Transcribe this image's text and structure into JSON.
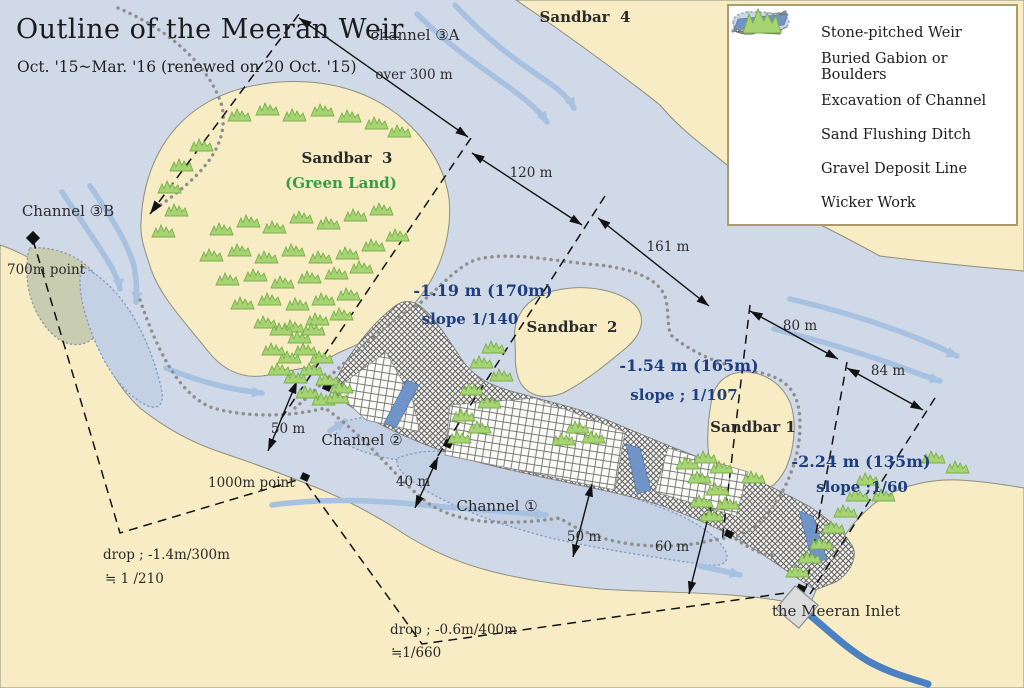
{
  "title": {
    "main": "Outline of the Meeran Weir",
    "subtitle": "Oct. '15~Mar. '16 (renewed on 20 Oct. '15)"
  },
  "legend": {
    "items": [
      {
        "icon": "stone-pitched-weir-swatch",
        "label": "Stone-pitched Weir"
      },
      {
        "icon": "buried-gabion-swatch",
        "label": "Buried Gabion or Boulders"
      },
      {
        "icon": "excavation-swatch",
        "label": "Excavation of Channel"
      },
      {
        "icon": "sand-flushing-ditch-swatch",
        "label": "Sand Flushing Ditch"
      },
      {
        "icon": "gravel-deposit-line-swatch",
        "label": "Gravel Deposit Line"
      },
      {
        "icon": "wicker-work-swatch",
        "label": "Wicker Work"
      }
    ]
  },
  "labels": {
    "sandbar4": "Sandbar  4",
    "sandbar3": "Sandbar  3",
    "green_land": "(Green Land)",
    "sandbar2": "Sandbar  2",
    "sandbar1": "Sandbar 1",
    "channel_3a": "channel ③A",
    "channel_3b": "Channel ③B",
    "channel_2": "Channel ②",
    "channel_1": "Channel ①",
    "inlet": "the Meeran Inlet",
    "point_700": "700m point",
    "point_1000": "1000m point"
  },
  "measurements": {
    "over_300": "over 300 m",
    "m120": "120 m",
    "m161": "161 m",
    "m80": "80 m",
    "m84": "84 m",
    "m50_upper": "50 m",
    "m40": "40 m",
    "m50_lower": "50 m",
    "m60": "60 m",
    "depth_1": "-1.19 m (170m)",
    "slope_1": "slope 1/140",
    "depth_2": "-1.54 m (165m)",
    "slope_2": "slope ; 1/107",
    "depth_3": "-2.24 m (135m)",
    "slope_3": "slope ;1/60",
    "drop_1": "drop ; -1.4m/300m",
    "drop_1_ratio": "≒ 1 /210",
    "drop_2": "drop ; -0.6m/400m",
    "drop_2_ratio": "≒1/660"
  },
  "colors": {
    "water": "#cfd9e7",
    "sand": "#f7ecc4",
    "excavation": "#c4d1e4",
    "ditch_blue": "#7094c8",
    "flow_arrow": "#a7c1e0",
    "wicker_green": "#a6d473",
    "navy_text": "#1e3e7e",
    "green_text": "#359c49",
    "legend_border": "#ab9b6d"
  }
}
